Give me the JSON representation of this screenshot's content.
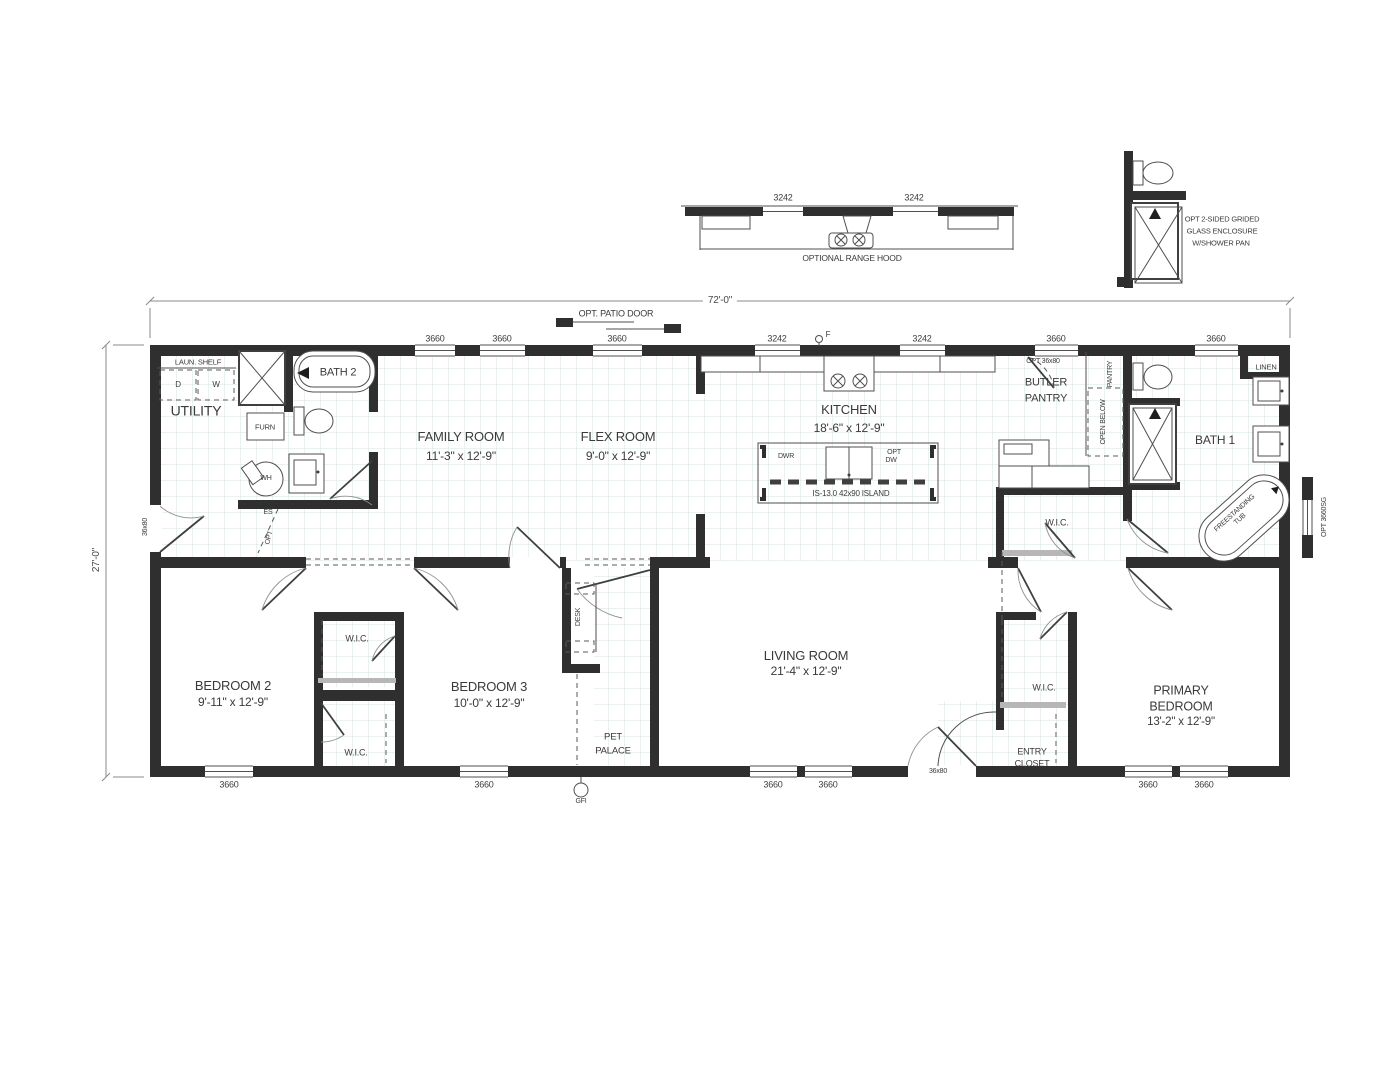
{
  "plan": {
    "dim_width": "72'-0\"",
    "dim_height": "27'-0\"",
    "patio_door_label": "OPT. PATIO DOOR"
  },
  "details": {
    "range_hood": {
      "title": "OPTIONAL RANGE HOOD",
      "window_left": "3242",
      "window_right": "3242"
    },
    "shower": {
      "line1": "OPT 2-SIDED GRIDED",
      "line2": "GLASS ENCLOSURE",
      "line3": "W/SHOWER PAN"
    }
  },
  "rooms": {
    "utility": "UTILITY",
    "bath2": "BATH 2",
    "family_name": "FAMILY ROOM",
    "family_dims": "11'-3\" x 12'-9\"",
    "flex_name": "FLEX ROOM",
    "flex_dims": "9'-0\" x 12'-9\"",
    "kitchen_name": "KITCHEN",
    "kitchen_dims": "18'-6\" x 12'-9\"",
    "butler_line1": "BUTLER",
    "butler_line2": "PANTRY",
    "bath1": "BATH 1",
    "linen": "LINEN",
    "wic": "W.I.C.",
    "bedroom2_name": "BEDROOM 2",
    "bedroom2_dims": "9'-11\" x 12'-9\"",
    "bedroom3_name": "BEDROOM 3",
    "bedroom3_dims": "10'-0\" x 12'-9\"",
    "pet_line1": "PET",
    "pet_line2": "PALACE",
    "living_name": "LIVING ROOM",
    "living_dims": "21'-4\" x 12'-9\"",
    "entry_line1": "ENTRY",
    "entry_line2": "CLOSET",
    "primary_line1": "PRIMARY",
    "primary_line2": "BEDROOM",
    "primary_dims": "13'-2\" x 12'-9\""
  },
  "fixtures": {
    "laun_shelf": "LAUN. SHELF",
    "dryer": "D",
    "washer": "W",
    "furnace": "FURN",
    "water_heater": "WH",
    "electrical_panel": "ES",
    "opt_door": "OPT",
    "pantry": "PANTRY",
    "open_below": "OPEN BELOW",
    "drawer": "DWR",
    "opt_dw_1": "OPT",
    "opt_dw_2": "DW",
    "island": "IS-13.0  42x90 ISLAND",
    "desk": "DESK",
    "gfi": "GFI",
    "hose_bib": "F",
    "tub_line1": "FREESTANDING",
    "tub_line2": "TUB",
    "opt_pantry_door": "OPT 36x80",
    "opt_right_window": "OPT 3660SG"
  },
  "openings": {
    "top_windows": [
      "3660",
      "3660",
      "3660",
      "3242",
      "3242",
      "3660",
      "3660"
    ],
    "bottom_windows": [
      "3660",
      "3660",
      "3660",
      "3660",
      "3660",
      "3660"
    ],
    "left_door": "36x80",
    "entry_door": "36x80"
  }
}
